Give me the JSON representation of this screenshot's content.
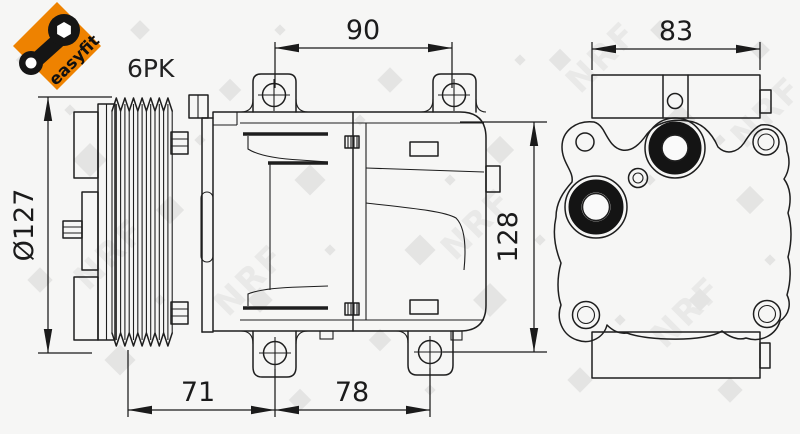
{
  "badge": {
    "label": "easyfit",
    "background_color": "#EE8200"
  },
  "labels": {
    "belt_type": "6PK"
  },
  "dimensions": {
    "top_span": "90",
    "rear_width": "83",
    "pulley_diameter": "Ø127",
    "body_height": "128",
    "bottom_front_span": "71",
    "bottom_rear_span": "78"
  },
  "watermark": {
    "text": "NRF"
  },
  "colors": {
    "line": "#1e1e1e",
    "background": "#f6f6f5",
    "watermark": "#d3d3d3"
  }
}
